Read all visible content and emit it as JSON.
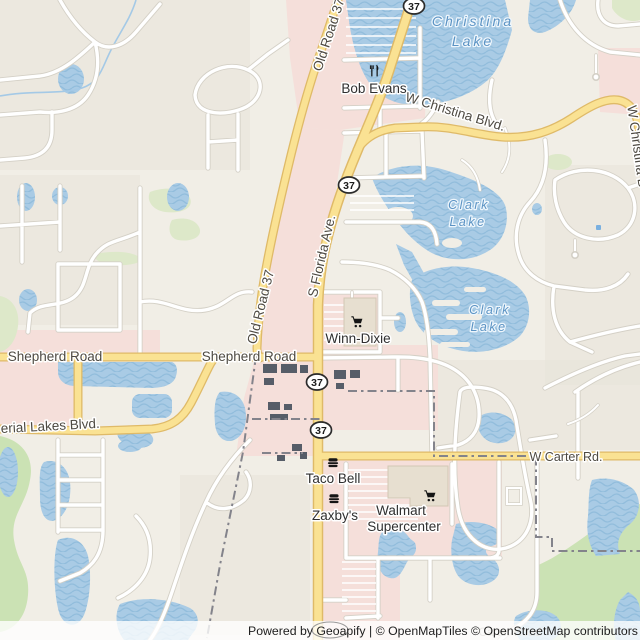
{
  "map": {
    "route_shields": [
      {
        "label": "37"
      },
      {
        "label": "37"
      },
      {
        "label": "37"
      },
      {
        "label": "37"
      }
    ],
    "road_labels": {
      "old_road_37_north": "Old Road 37",
      "old_road_37_south": "Old Road 37",
      "s_florida_ave": "S Florida Ave.",
      "w_christina_blvd": "W Christina Blvd.",
      "w_christina_blvd_east": "W Christina B",
      "shepherd_road_west": "Shepherd Road",
      "shepherd_road_east": "Shepherd Road",
      "imperial_lakes_blvd": "erial Lakes Blvd.",
      "w_carter_rd": "W Carter Rd.",
      "carter_road_faint": "Carter Road"
    },
    "water_labels": {
      "christina_lake_line1": "Christina",
      "christina_lake_line2": "Lake",
      "clark_lake_north_line1": "Clark",
      "clark_lake_north_line2": "Lake",
      "clark_lake_south_line1": "Clark",
      "clark_lake_south_line2": "Lake"
    },
    "pois": {
      "bob_evans": {
        "name": "Bob Evans",
        "icon": "restaurant-icon"
      },
      "winn_dixie": {
        "name": "Winn-Dixie",
        "icon": "shopping-cart-icon"
      },
      "taco_bell": {
        "name": "Taco Bell",
        "icon": "fast-food-icon"
      },
      "zaxbys": {
        "name": "Zaxby's",
        "icon": "fast-food-icon"
      },
      "walmart": {
        "name_line1": "Walmart",
        "name_line2": "Supercenter",
        "icon": "shopping-cart-icon"
      }
    },
    "attribution": {
      "text": "Powered by Geoapify | © OpenMapTiles © OpenStreetMap contributors"
    },
    "colors": {
      "background": "#f1eee6",
      "water": "#a9cbe5",
      "wave": "#92bddc",
      "stream": "#a4c9e6",
      "road_yellow": "#fae293",
      "road_yellow_casing": "#dfba68",
      "road_white": "#ffffff",
      "road_casing": "#d4d0c6",
      "landuse_pink": "#f5dfda",
      "landuse_green": "#cbe2b4",
      "landuse_green2": "#dde8c9",
      "boundary": "#83838b",
      "label_road": "#4e4a42",
      "label_poi": "#2f2f2f",
      "label_water": "#5b93c4",
      "building_dark": "#565d68",
      "building_light": "#e7dfd0",
      "attribution_bg": "rgba(255,255,255,0.78)"
    }
  }
}
